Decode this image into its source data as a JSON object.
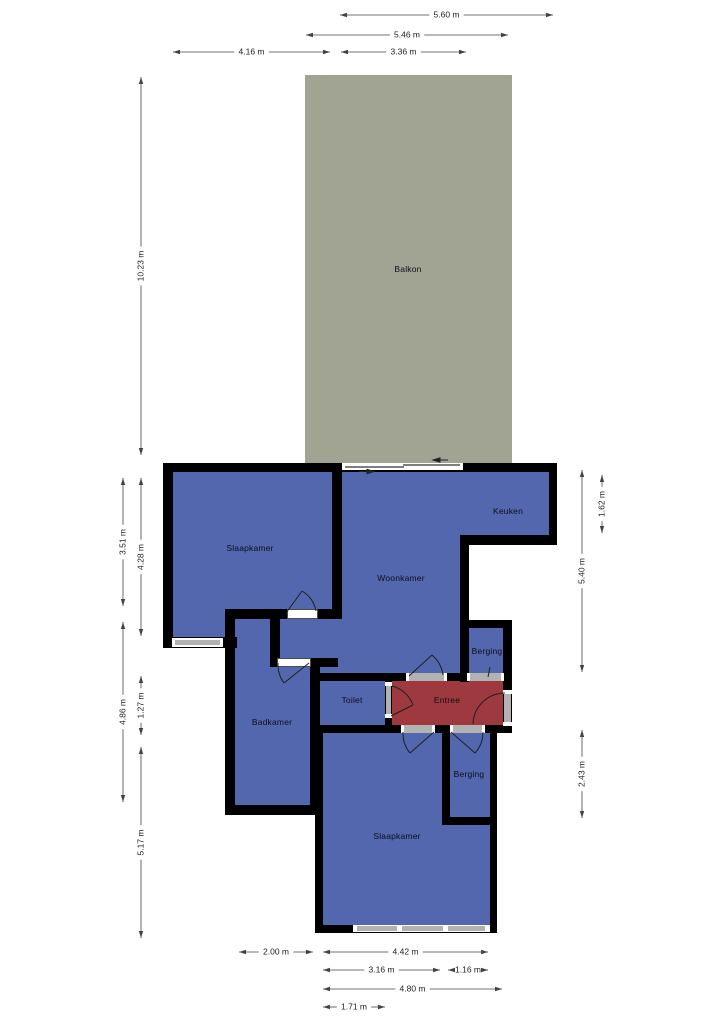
{
  "title": "Floor plan (plattegrond)",
  "rooms": {
    "balkon": "Balkon",
    "slaapkamer_top": "Slaapkamer",
    "woonkamer": "Woonkamer",
    "keuken": "Keuken",
    "badkamer": "Badkamer",
    "toilet": "Toilet",
    "entree": "Entree",
    "berging_top": "Berging",
    "berging_bottom": "Berging",
    "slaapkamer_bottom": "Slaapkamer"
  },
  "colors": {
    "wall": "#000000",
    "room_blue": "#5267ae",
    "entree_red": "#9e3a3f",
    "balkon_gray": "#a2a493",
    "opening_gray": "#b2b2b2",
    "dimension_line": "#444444",
    "label_text": "#0d0d1a"
  },
  "dimensions": [
    {
      "label": "5.60 m",
      "dir": "h",
      "at": 15,
      "from": 340,
      "to": 553
    },
    {
      "label": "5.46 m",
      "dir": "h",
      "at": 35,
      "from": 306,
      "to": 508
    },
    {
      "label": "4.16 m",
      "dir": "h",
      "at": 52,
      "from": 173,
      "to": 330
    },
    {
      "label": "3.36 m",
      "dir": "h",
      "at": 52,
      "from": 341,
      "to": 466
    },
    {
      "label": "10.23 m",
      "dir": "v",
      "at": 141,
      "from": 77,
      "to": 455
    },
    {
      "label": "3.51 m",
      "dir": "v",
      "at": 123,
      "from": 478,
      "to": 606
    },
    {
      "label": "4.28 m",
      "dir": "v",
      "at": 141,
      "from": 478,
      "to": 636
    },
    {
      "label": "4.86 m",
      "dir": "v",
      "at": 123,
      "from": 622,
      "to": 802
    },
    {
      "label": "1.27 m",
      "dir": "v",
      "at": 141,
      "from": 676,
      "to": 735
    },
    {
      "label": "5.17 m",
      "dir": "v",
      "at": 141,
      "from": 747,
      "to": 938
    },
    {
      "label": "1.62 m",
      "dir": "v",
      "at": 602,
      "from": 475,
      "to": 533
    },
    {
      "label": "5.40 m",
      "dir": "v",
      "at": 582,
      "from": 470,
      "to": 672
    },
    {
      "label": "2.43 m",
      "dir": "v",
      "at": 582,
      "from": 730,
      "to": 818
    },
    {
      "label": "2.00 m",
      "dir": "h",
      "at": 952,
      "from": 239,
      "to": 313
    },
    {
      "label": "4.42 m",
      "dir": "h",
      "at": 952,
      "from": 323,
      "to": 488
    },
    {
      "label": "3.16 m",
      "dir": "h",
      "at": 970,
      "from": 323,
      "to": 440
    },
    {
      "label": "1.16 m",
      "dir": "h",
      "at": 970,
      "from": 448,
      "to": 488
    },
    {
      "label": "4.80 m",
      "dir": "h",
      "at": 989,
      "from": 323,
      "to": 502
    },
    {
      "label": "1.71 m",
      "dir": "h",
      "at": 1007,
      "from": 323,
      "to": 385
    }
  ]
}
